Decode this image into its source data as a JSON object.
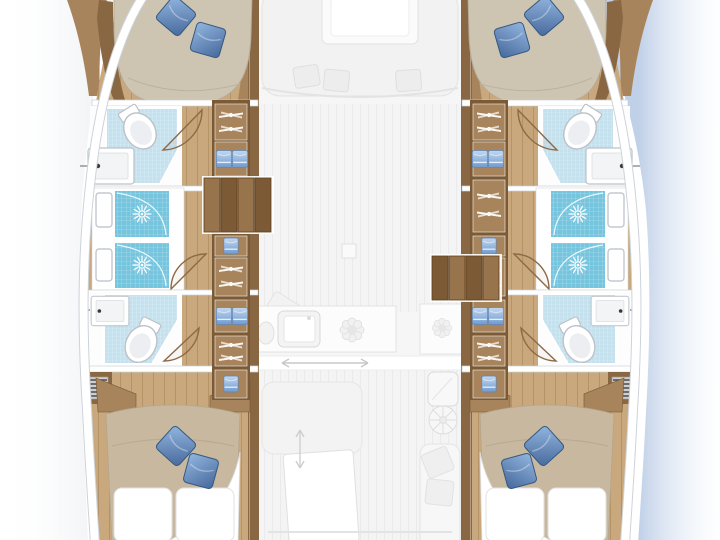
{
  "page": {
    "title": "Catamaran yacht interior layout plan — 4 cabins, 4 heads (top-down floor plan illustration)"
  },
  "palette": {
    "background": "#ffffff",
    "water-shadow": "#bdcde6",
    "wood-wall": "#8a6743",
    "wood-wall-light": "#a8845c",
    "wood-floor": "#c9a87d",
    "wood-plank-line": "#a07e50",
    "steps-light": "#97744c",
    "steps-dark": "#7c5a36",
    "mattress": "#cec4b2",
    "duvet": "#c7b89f",
    "pillow-main": "#6e96c8",
    "pillow-dark": "#3f669a",
    "bath-floor": "#c3e1ee",
    "shower-tile": "#76c5df",
    "towel-blue": "#8fb3dc",
    "fixture-stroke": "#b9bec5",
    "door-arc": "#8d6a45",
    "faded-fill": "#f2f2f2",
    "faded-line": "#e3e3e3"
  },
  "plan": {
    "style": "top-down yacht layout illustration, hulls rendered in color, central deck level shown faded",
    "center_deck_faded": true,
    "fixtures_summary": {
      "cabins": 4,
      "heads": 4,
      "shower_stalls": 4,
      "toilets": 4,
      "washbasins": 4,
      "vanity_units": 4,
      "blue_pillows": 8,
      "white_berth_pillows": 4
    },
    "hulls": [
      {
        "side": "port",
        "position": "left",
        "rooms": [
          {
            "name": "fore-cabin",
            "furniture": [
              "double-berth",
              "blue-pillow",
              "blue-pillow",
              "bow-deck"
            ]
          },
          {
            "name": "fore-head",
            "fixtures": [
              "toilet",
              "washbasin",
              "door-arc",
              "shower-stall-with-drain",
              "vanity-unit"
            ]
          },
          {
            "name": "aft-head",
            "fixtures": [
              "shower-stall-with-drain",
              "vanity-unit",
              "washbasin",
              "toilet",
              "door-arc",
              "louver-vent"
            ]
          },
          {
            "name": "aft-cabin",
            "furniture": [
              "double-berth",
              "duvet-turned-down",
              "blue-pillow",
              "blue-pillow",
              "white-pillow",
              "white-pillow",
              "nightstand",
              "nightstand"
            ]
          }
        ],
        "corridor_storage": [
          "wardrobe-hangers",
          "towel-shelf",
          "wardrobe-hangers",
          "towel-shelf",
          "wardrobe-hangers",
          "towel-shelf",
          "wardrobe-hangers",
          "towel-shelf"
        ],
        "companionway_steps": {
          "treads": 4,
          "location": "forward of midship"
        }
      },
      {
        "side": "starboard",
        "position": "right",
        "mirror_of": "port",
        "companionway_steps": {
          "treads": 4,
          "location": "aft of midship"
        }
      }
    ],
    "center": {
      "saloon": [
        "u-shaped-sofa",
        "saloon-table",
        "seat-cushion",
        "seat-cushion",
        "seat-cushion",
        "nav-seat",
        "utility-box"
      ],
      "galley": [
        "galley-counter",
        "galley-sink",
        "stove-burner",
        "stove-burner",
        "mini-appliance"
      ],
      "cockpit": [
        "sliding-door-track",
        "slide-arrow",
        "cockpit-bench",
        "cockpit-table",
        "slide-arrow-vertical",
        "wetbar-sink",
        "helm-wheel",
        "chaise-lounge",
        "chaise-pillow",
        "chaise-pillow",
        "transom-line"
      ]
    },
    "icons": {
      "shower-drain": "white sunburst",
      "wardrobe": "white clothes hangers on rail",
      "towel-shelf": "folded blue towels",
      "louver-vent": "dark horizontal stripes",
      "faucet": "black dot",
      "slide-arrow": "double-headed arrow"
    },
    "shading": {
      "right_side": "soft blue water shadow along starboard hull",
      "left_side": "very light gray falloff"
    }
  }
}
